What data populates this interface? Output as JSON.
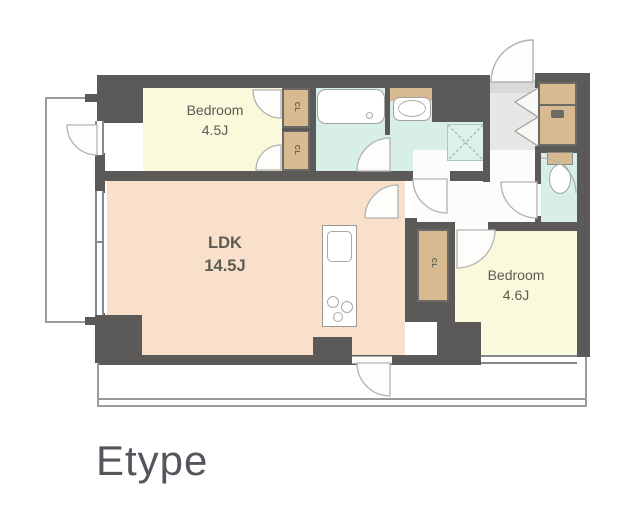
{
  "title": "Etype",
  "rooms": {
    "bedroom1": {
      "name": "Bedroom",
      "area": "4.5J"
    },
    "ldk": {
      "name": "LDK",
      "area": "14.5J"
    },
    "bedroom2": {
      "name": "Bedroom",
      "area": "4.6J"
    }
  },
  "closets": {
    "cl1": "CL",
    "cl2": "CL",
    "cl3": "CL"
  },
  "fixtures": [
    "bathtub",
    "washbasin",
    "washing-machine-pan",
    "toilet",
    "kitchen-counter",
    "shoe-cabinet",
    "entrance-door",
    "folding-closet-door"
  ],
  "colors": {
    "wall": "#5b5a58",
    "bedroom_floor": "#fbf9dc",
    "ldk_floor": "#f9e0cb",
    "wet_area_floor": "#d7efe8",
    "storage_tan": "#d8ba90",
    "entrance_floor": "#e7e7e5",
    "balcony_line": "#9a9a9a",
    "label_text": "#5c5c52",
    "title_text": "#54565e"
  }
}
